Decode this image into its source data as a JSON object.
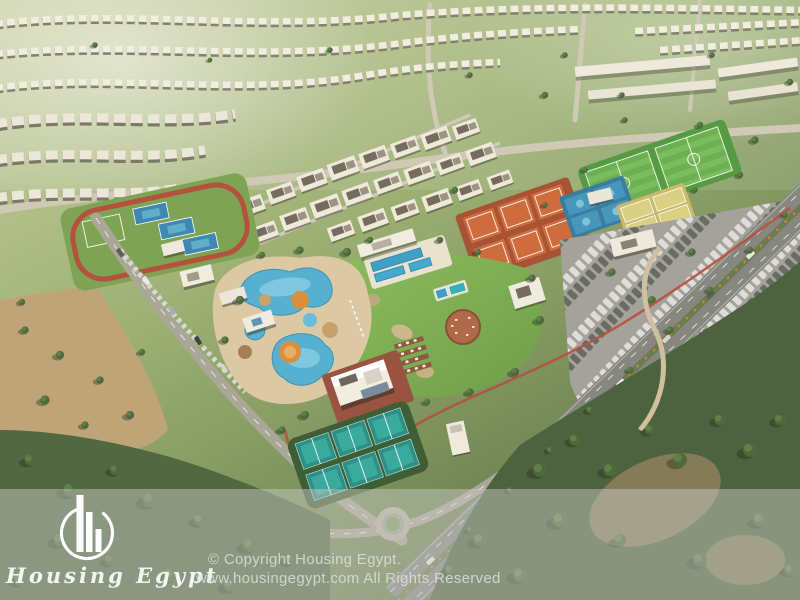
{
  "image": {
    "kind": "aerial-architectural-render",
    "description": "Bird's-eye 3D render of a master-planned residential community: villa rows and apartment blocks, a central club area with water park, lagoon pools, lawn, clay and teal tennis courts, football pitches, parking lots and tree belts, with a translucent watermark strip at the bottom."
  },
  "watermark": {
    "brand_name": "Housing Egypt",
    "logo_icon": "buildings-in-circle-icon",
    "copyright_line1": "© Copyright Housing Egypt.",
    "copyright_line2": "www.housingegypt.com All Rights Reserved",
    "text_color": "#e1e1de",
    "overlay_color": "rgba(203,202,196,0.48)"
  },
  "scene": {
    "regions": [
      "villa-rows-north",
      "apartment-district",
      "school-complex",
      "football-fields",
      "clay-tennis-courts",
      "blue-sports-courts",
      "padel-courts",
      "left-sports-cluster",
      "running-track",
      "water-park",
      "lagoon-pools",
      "swimming-pools",
      "central-lawn",
      "clubhouse",
      "teal-tennis-courts",
      "arterial-road",
      "parking-lot",
      "roundabout",
      "forest-belt",
      "desert-grove"
    ],
    "palette": {
      "grass_light": "#aebe85",
      "lawn_green": "#7cb050",
      "forest_green": "#4d6340",
      "desert_tan": "#bfa477",
      "villa_white": "#f1eddf",
      "clay_court": "#cf6c3e",
      "pool_blue": "#45a3c4",
      "teal_court": "#2f8f86",
      "padel_yellow": "#dacf82",
      "track_red": "#b5513c",
      "asphalt": "#878780",
      "terrace_brown": "#9a5340"
    }
  }
}
